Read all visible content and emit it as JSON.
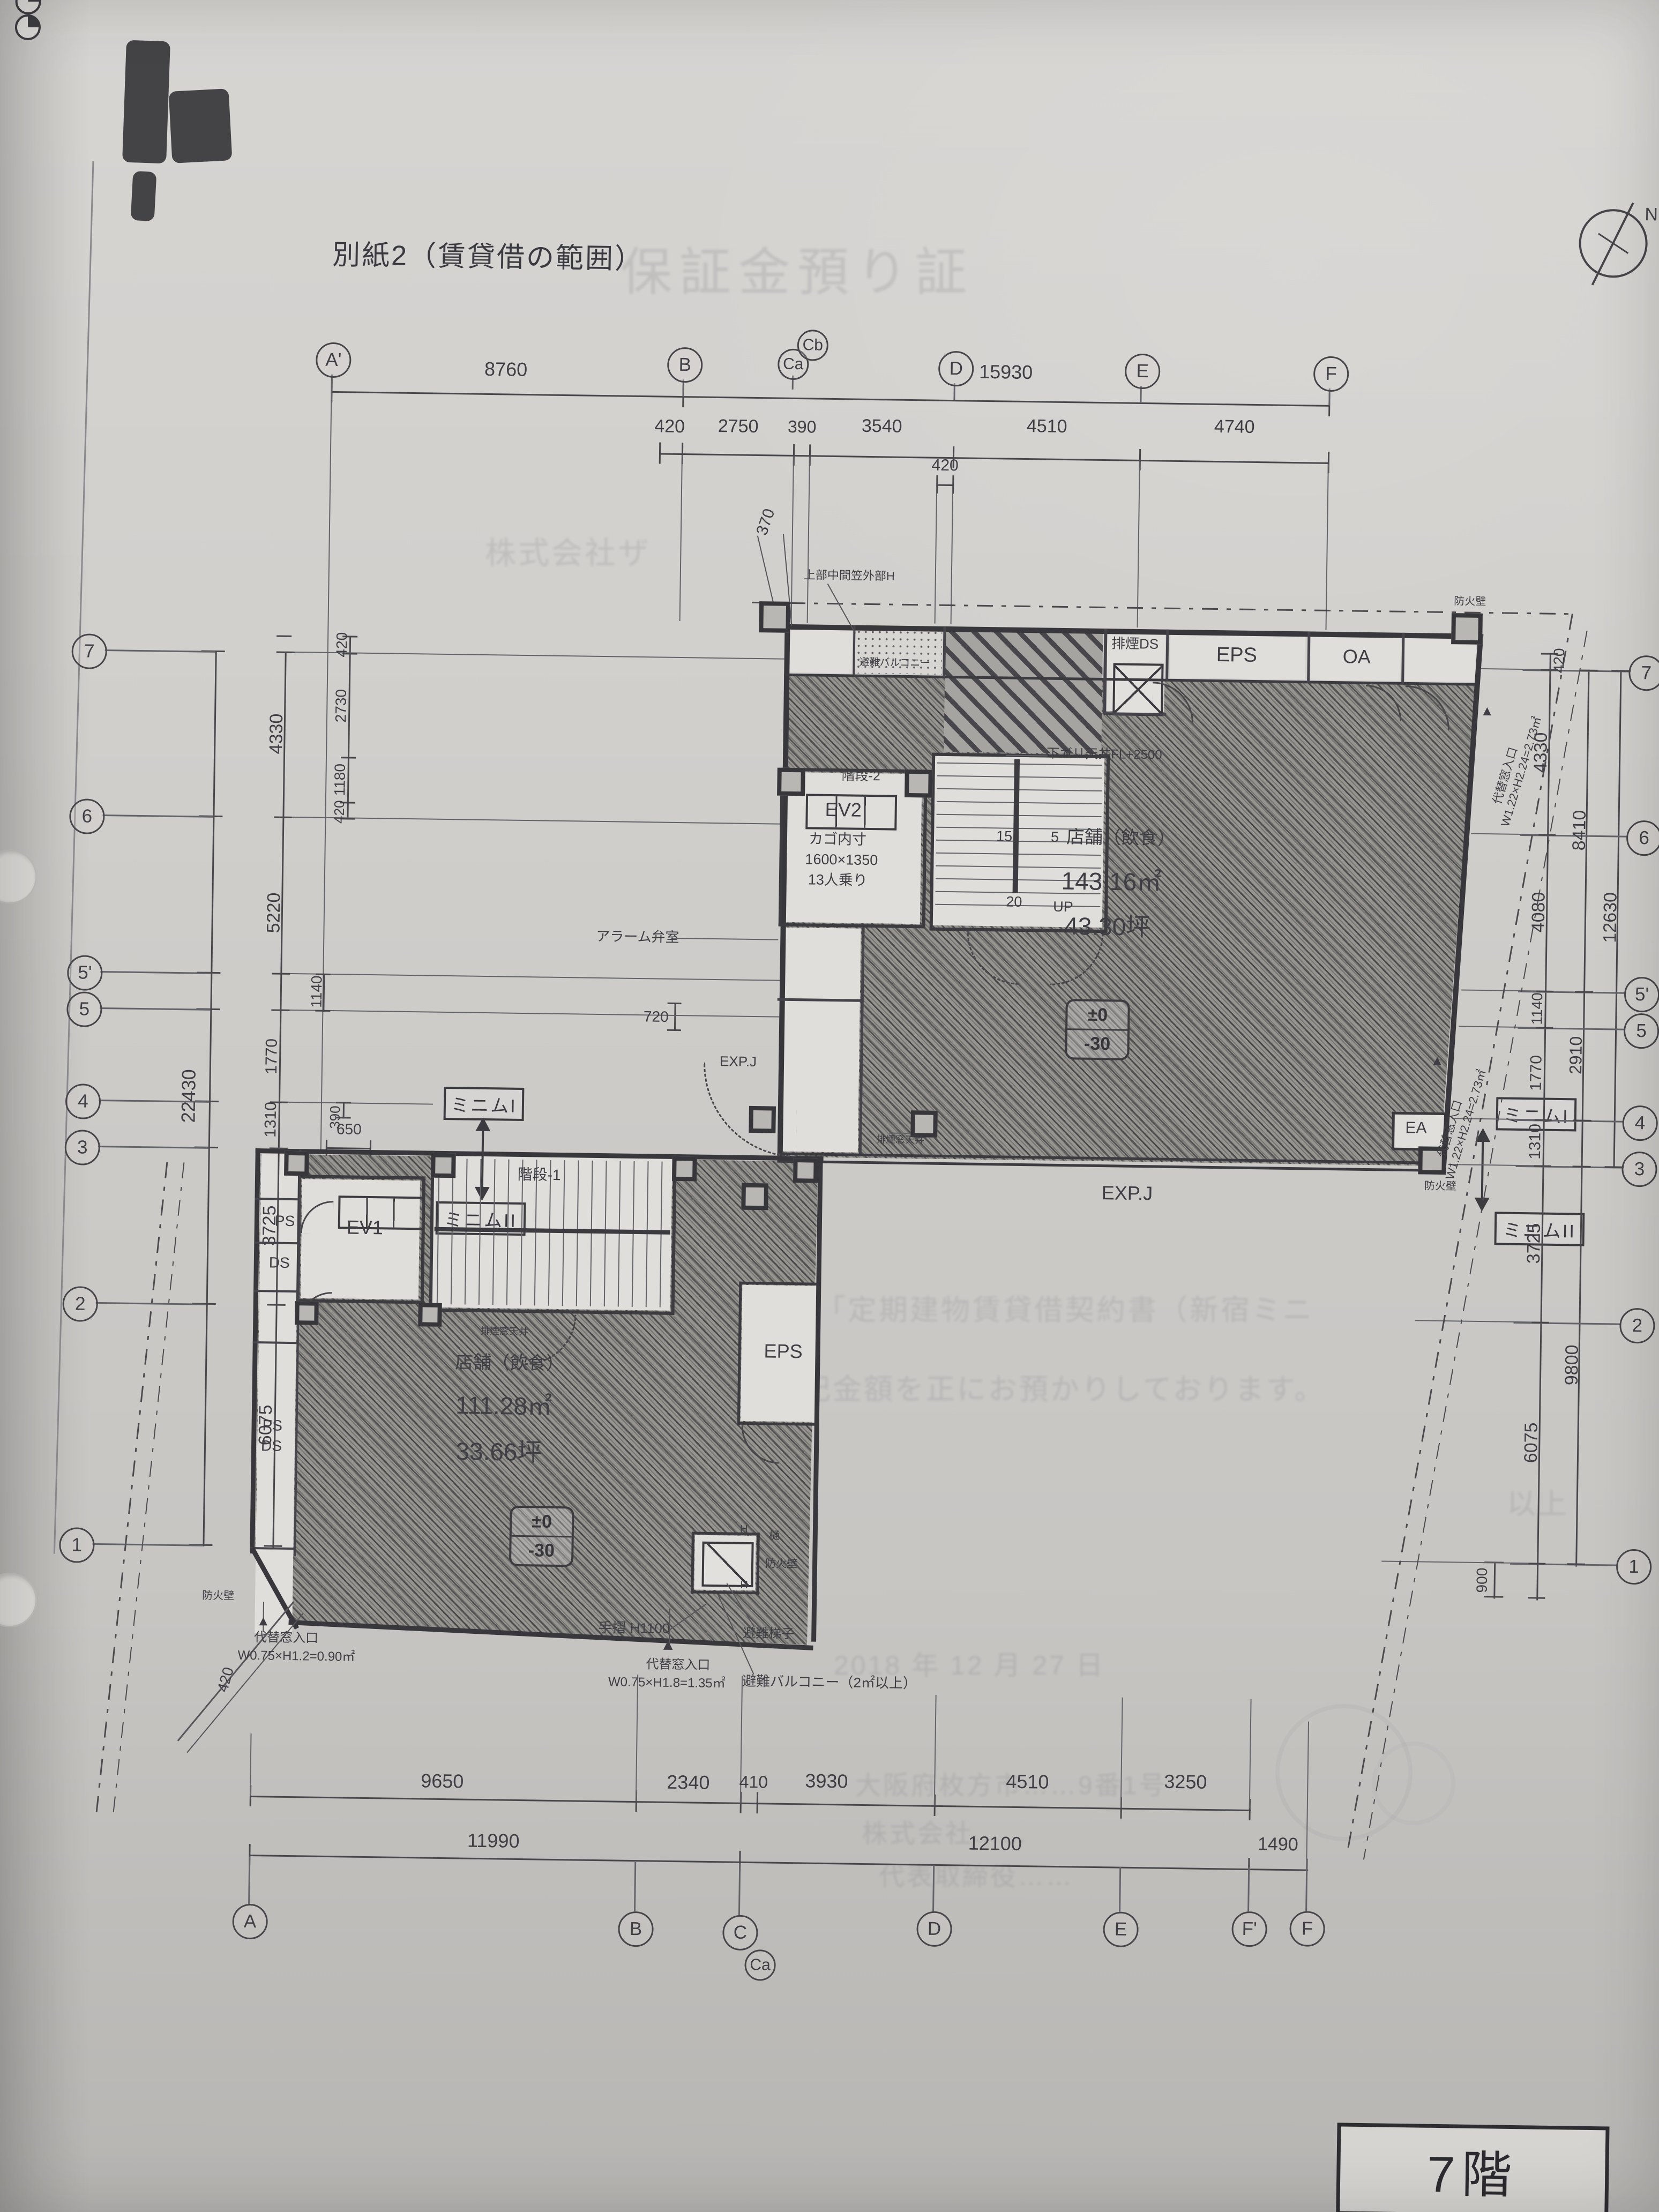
{
  "page": {
    "title": "別紙2（賃貸借の範囲）",
    "floor_badge": "7階",
    "north": "N"
  },
  "grid": {
    "top": [
      "A'",
      "B",
      "Ca",
      "Cb",
      "D",
      "E",
      "F"
    ],
    "bottom": [
      "A",
      "B",
      "C",
      "Ca",
      "D",
      "E",
      "F'",
      "F"
    ],
    "side": [
      "7",
      "6",
      "5'",
      "5",
      "4",
      "3",
      "2",
      "1"
    ]
  },
  "dims": {
    "top1": [
      "8760",
      "15930"
    ],
    "top2": [
      "420",
      "2750",
      "390",
      "3540",
      "4510",
      "4740"
    ],
    "top_small": "420",
    "dim370": "370",
    "left_overall": "22430",
    "left_major": [
      "4330",
      "5220",
      "1770",
      "1310",
      "3725",
      "6075"
    ],
    "left_sub": [
      "420",
      "2730",
      "1180",
      "420",
      "1140",
      "390"
    ],
    "dim650": "650",
    "dim720": "720",
    "right_inner": [
      "420",
      "4330",
      "4080",
      "1140",
      "1770",
      "1310",
      "3725",
      "6075",
      "900"
    ],
    "right_mid": [
      "8410",
      "2910",
      "9800"
    ],
    "right_outer": "12630",
    "bottom1": [
      "9650",
      "2340",
      "410",
      "3930",
      "4510",
      "3250"
    ],
    "bottom2": [
      "11990",
      "12100",
      "1490"
    ],
    "dim420_sw": "420"
  },
  "rooms": {
    "eps_upper": "EPS",
    "oa": "OA",
    "smoke_ds": "排煙DS",
    "ev2": "EV2",
    "ev2_note": [
      "カゴ内寸",
      "1600×1350",
      "13人乗り"
    ],
    "stair_upper": "階段-2",
    "stair_lower": "階段-1",
    "tread15": "15",
    "tread5": "5",
    "tread20": "20",
    "up": "UP",
    "ea": "EA",
    "eps_lower": "EPS",
    "ps": "PS",
    "ds": "DS",
    "ps2": "PS",
    "ds2": "DS",
    "ev1": "EV1"
  },
  "tenant_upper": {
    "use": "店舗（飲食）",
    "area_m2": "143.16㎡",
    "area_tsubo": "43.30坪",
    "fl": "±0",
    "fl2": "-30"
  },
  "tenant_lower": {
    "use": "店舗（飲食）",
    "area_m2": "111.28㎡",
    "area_tsubo": "33.66坪",
    "fl": "±0",
    "fl2": "-30"
  },
  "ann": {
    "exp_j": "EXP.J",
    "exp_j_small": "EXP.J",
    "alarm": "アラーム弁室",
    "parapet": "上部中間笠外部H",
    "ceiling": "下ガリ天井FL+2500",
    "balcony_top": "避難バルコニー",
    "handrail": "手摺 H1100",
    "marker": "▲",
    "hatch": "避難梯子",
    "balcony": "避難バルコニー（2㎡以上）",
    "win_sw": [
      "代替窓入口",
      "W0.75×H1.2=0.90㎡"
    ],
    "win_s": [
      "代替窓入口",
      "W0.75×H1.8=1.35㎡"
    ],
    "win_e": [
      "代替窓入口",
      "W1.22×H2.24=2.73㎡"
    ],
    "firewall": "防火壁",
    "gutter": "樋",
    "smoke_win": "排煙窓天井",
    "h": "H",
    "minim1": "ミニムI",
    "minim2": "ミニムII"
  },
  "ghost": {
    "title": "保証金預り証",
    "addressee": "株式会社ザ",
    "body1": "件の「定期建物賃貸借契約書（新宿ミニ",
    "body2": "記金額を正にお預かりしております。",
    "close": "以上",
    "date": "2018 年 12 月 27 日",
    "addr": "大阪府枚方市……9番1号",
    "company": "株式会社……",
    "rep": "代表取締役……"
  }
}
